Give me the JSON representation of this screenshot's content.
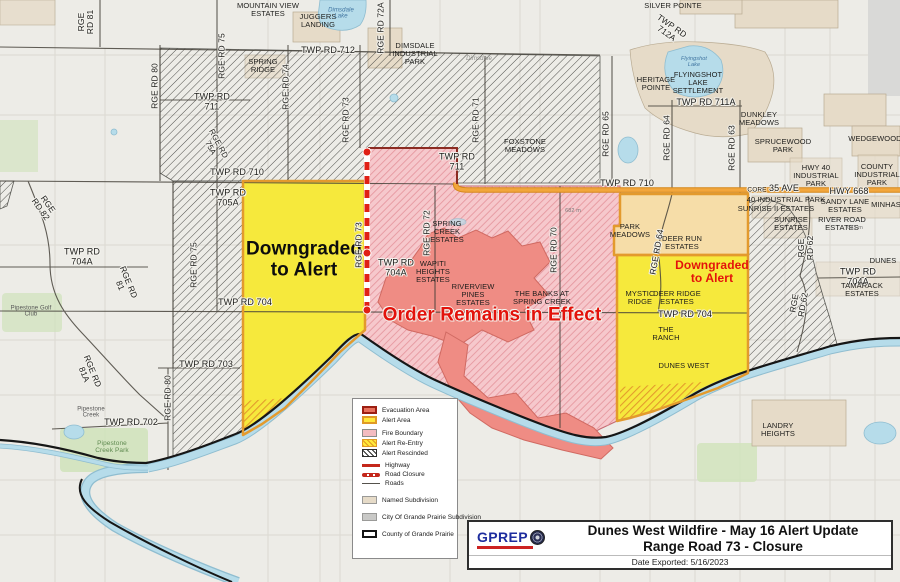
{
  "colors": {
    "bg": "#edece7",
    "alert_yellow": "#f6e93c",
    "alert_border": "#e39a2d",
    "evacuation_salmon": "#ef8c84",
    "fire_pink": "#f6c8cc",
    "fire_hatch": "#e698a0",
    "rescinded_line": "#3c3c38",
    "highway_orange": "#f2a63c",
    "highway_casing": "#d5881c",
    "closure_red": "#e02015",
    "river_blue": "#b6dcea",
    "river_casing": "#8fbdd0",
    "boundary_black": "#161616",
    "tan_subdivision": "#e6dbc8",
    "gray_subdivision": "#d9d9d7",
    "green_park": "#cfe3ba",
    "road_dark": "#454239"
  },
  "legend": {
    "items": [
      {
        "label": "Evacuation Area",
        "swatch": {
          "type": "rect",
          "fill": "#e8705c",
          "border": "#9c1f12",
          "bw": 2
        }
      },
      {
        "label": "Alert Area",
        "swatch": {
          "type": "rect",
          "fill": "#ffe93b",
          "border": "#e09a26",
          "bw": 2
        }
      },
      {
        "label": "Fire Boundary",
        "swatch": {
          "type": "rect",
          "fill": "#f4bcc1",
          "border": "#8d8d8b",
          "bw": 1
        }
      },
      {
        "label": "Alert Re-Entry",
        "swatch": {
          "type": "hatch",
          "fill": "#ffe93b",
          "line": "#e09a26",
          "border": "#e09a26",
          "bw": 1
        }
      },
      {
        "label": "Alert Rescinded",
        "swatch": {
          "type": "hatch",
          "fill": "#ffffff",
          "line": "#2e2e2c",
          "border": "#2e2e2c",
          "bw": 1
        }
      },
      {
        "label": "Highway",
        "swatch": {
          "type": "line",
          "color": "#c4271b"
        }
      },
      {
        "label": "Road Closure",
        "swatch": {
          "type": "dash",
          "color": "#c4271b"
        }
      },
      {
        "label": "Roads",
        "swatch": {
          "type": "thin",
          "color": "#55524c"
        }
      },
      {
        "label": "Named Subdivision",
        "swatch": {
          "type": "rect",
          "fill": "#e6dbc8",
          "border": "#9a9a98",
          "bw": 1
        }
      },
      {
        "label": "City Of Grande Prairie Subdivision",
        "swatch": {
          "type": "rect",
          "fill": "#c9c9c7",
          "border": "#9a9a98",
          "bw": 1
        }
      },
      {
        "label": "County of Grande Prairie",
        "swatch": {
          "type": "rect",
          "fill": "#ffffff",
          "border": "#141414",
          "bw": 2
        }
      }
    ]
  },
  "title_box": {
    "logo": "GPREP",
    "line1": "Dunes West Wildfire - May 16 Alert Update",
    "line2": "Range Road 73 - Closure",
    "date": "Date Exported: 5/16/2023"
  },
  "map": {
    "labels": [
      {
        "n": "mountain-view-estates-label",
        "t": "MOUNTAIN VIEW\nESTATES",
        "x": 268,
        "y": 10,
        "s": 7.5
      },
      {
        "n": "silver-pointe-label",
        "t": "SILVER POINTE",
        "x": 673,
        "y": 6,
        "s": 7.5
      },
      {
        "n": "juggers-landing-label",
        "t": "JUGGERS\nLANDING",
        "x": 318,
        "y": 21,
        "s": 7.5
      },
      {
        "n": "twp-rd-712a-label",
        "t": "TWP RD\n712A",
        "x": 669,
        "y": 30,
        "s": 8.5,
        "r": 35,
        "h": 1
      },
      {
        "n": "twp-rd-712-label",
        "t": "TWP RD 712",
        "x": 328,
        "y": 51,
        "s": 9,
        "h": 1
      },
      {
        "n": "dimsdale-industrial-park-label",
        "t": "DIMSDALE\nINDUSTRIAL\nPARK",
        "x": 415,
        "y": 54,
        "s": 7.5
      },
      {
        "n": "dimsdale-lake-label",
        "t": "Dimsdale\nLake",
        "x": 341,
        "y": 14,
        "s": 6,
        "i": 1,
        "c": "#3f74a0"
      },
      {
        "n": "rge-rd-81-label",
        "t": "RGE\nRD 81",
        "x": 86,
        "y": 22,
        "s": 8.5,
        "r": -90,
        "h": 1
      },
      {
        "n": "rge-rd-80-label",
        "t": "RGE RD 80",
        "x": 155,
        "y": 86,
        "s": 8.5,
        "r": -90,
        "h": 1
      },
      {
        "n": "rge-rd-75-label",
        "t": "RGE RD 75",
        "x": 222,
        "y": 56,
        "s": 8.5,
        "r": -90,
        "h": 1
      },
      {
        "n": "spring-ridge-label",
        "t": "SPRING\nRIDGE",
        "x": 263,
        "y": 66,
        "s": 7.5
      },
      {
        "n": "rge-rd-74-label",
        "t": "RGE RD 74",
        "x": 286,
        "y": 87,
        "s": 8.5,
        "r": -90,
        "h": 1
      },
      {
        "n": "twp-rd-711-label-west",
        "t": "TWP RD\n711",
        "x": 212,
        "y": 102,
        "s": 9,
        "h": 1
      },
      {
        "n": "rge-rd-75a-label",
        "t": "RGE RD\n75A",
        "x": 214,
        "y": 146,
        "s": 8,
        "r": 62,
        "h": 1
      },
      {
        "n": "twp-rd-710-label-west",
        "t": "TWP RD 710",
        "x": 237,
        "y": 173,
        "s": 9,
        "h": 1
      },
      {
        "n": "rge-rd-73-label-north",
        "t": "RGE RD 73",
        "x": 346,
        "y": 120,
        "s": 8.5,
        "r": -90,
        "h": 1
      },
      {
        "n": "rge-rd-72a-label",
        "t": "RGE RD 72A",
        "x": 381,
        "y": 28,
        "s": 8.5,
        "r": -90,
        "h": 1
      },
      {
        "n": "rge-rd-71-label",
        "t": "RGE RD 71",
        "x": 476,
        "y": 120,
        "s": 8.5,
        "r": -90,
        "h": 1
      },
      {
        "n": "twp-rd-711-label-mid",
        "t": "TWP RD\n711",
        "x": 457,
        "y": 162,
        "s": 9,
        "h": 1
      },
      {
        "n": "foxstone-meadows-label",
        "t": "FOXSTONE\nMEADOWS",
        "x": 525,
        "y": 146,
        "s": 7.5
      },
      {
        "n": "rge-rd-65-label",
        "t": "RGE RD 65",
        "x": 606,
        "y": 134,
        "s": 8.5,
        "r": -90,
        "h": 1
      },
      {
        "n": "twp-rd-711a-label",
        "t": "TWP RD 711A",
        "x": 706,
        "y": 103,
        "s": 9,
        "h": 1
      },
      {
        "n": "rge-rd-64-label-north",
        "t": "RGE RD 64",
        "x": 667,
        "y": 138,
        "s": 8.5,
        "r": -90,
        "h": 1
      },
      {
        "n": "rge-rd-63-label",
        "t": "RGE RD 63",
        "x": 732,
        "y": 148,
        "s": 8.5,
        "r": -90,
        "h": 1
      },
      {
        "n": "heritage-pointe-label",
        "t": "HERITAGE\nPOINTE",
        "x": 656,
        "y": 84,
        "s": 7.5
      },
      {
        "n": "flyingshot-lake-label",
        "t": "Flyingshot\nLake",
        "x": 694,
        "y": 63,
        "s": 5.5,
        "i": 1,
        "c": "#3f74a0"
      },
      {
        "n": "flyingshot-lake-settlement-label",
        "t": "FLYINGSHOT\nLAKE\nSETTLEMENT",
        "x": 698,
        "y": 83,
        "s": 7.5
      },
      {
        "n": "dunkley-meadows-label",
        "t": "DUNKLEY\nMEADOWS",
        "x": 759,
        "y": 119,
        "s": 7.5
      },
      {
        "n": "sprucewood-park-label",
        "t": "SPRUCEWOOD\nPARK",
        "x": 783,
        "y": 146,
        "s": 7.5
      },
      {
        "n": "wedgewood-label",
        "t": "WEDGEWOOD",
        "x": 875,
        "y": 139,
        "s": 7.5
      },
      {
        "n": "hwy-40-industrial-park-label",
        "t": "HWY 40\nINDUSTRIAL\nPARK",
        "x": 816,
        "y": 176,
        "s": 7.5
      },
      {
        "n": "county-industrial-park-label",
        "t": "COUNTY\nINDUSTRIAL\nPARK",
        "x": 877,
        "y": 175,
        "s": 7.5
      },
      {
        "n": "core-label",
        "t": "CORE",
        "x": 757,
        "y": 190,
        "s": 6.5,
        "h": 1
      },
      {
        "n": "ave-35-label",
        "t": "35 AVE",
        "x": 784,
        "y": 189,
        "s": 9,
        "h": 1
      },
      {
        "n": "hwy-668-label",
        "t": "HWY 668",
        "x": 849,
        "y": 192,
        "s": 9,
        "h": 1
      },
      {
        "n": "forty-industrial-park-label",
        "t": "40 INDUSTRIAL PARK",
        "x": 786,
        "y": 200,
        "s": 7.5
      },
      {
        "n": "sunrise-ii-estates-label",
        "t": "SUNRISE II ESTATES",
        "x": 776,
        "y": 209,
        "s": 7.5
      },
      {
        "n": "sandy-lane-estates-label",
        "t": "SANDY LANE\nESTATES",
        "x": 845,
        "y": 206,
        "s": 7.5
      },
      {
        "n": "minhas-label",
        "t": "MINHAS",
        "x": 886,
        "y": 205,
        "s": 7.5
      },
      {
        "n": "sunrise-estates-label",
        "t": "SUNRISE\nESTATES",
        "x": 791,
        "y": 224,
        "s": 7.5
      },
      {
        "n": "river-road-estates-label",
        "t": "RIVER ROAD\nESTATES",
        "x": 842,
        "y": 224,
        "s": 7.5
      },
      {
        "n": "rge-rd-62-label-upper",
        "t": "RGE\nRD 62",
        "x": 806,
        "y": 248,
        "s": 8.5,
        "r": -90,
        "h": 1
      },
      {
        "n": "rge-rd-62-label-lower",
        "t": "RGE\nRD 62",
        "x": 799,
        "y": 304,
        "s": 8.5,
        "r": -80,
        "h": 1
      },
      {
        "n": "twp-rd-704a-label-right",
        "t": "TWP RD 704A",
        "x": 858,
        "y": 277,
        "s": 9,
        "h": 1
      },
      {
        "n": "tamarack-estates-label",
        "t": "TAMARACK ESTATES",
        "x": 862,
        "y": 290,
        "s": 7.5
      },
      {
        "n": "dunes-label-edge",
        "t": "DUNES",
        "x": 883,
        "y": 261,
        "s": 7.5
      },
      {
        "n": "twp-rd-705a-label",
        "t": "TWP RD\n705A",
        "x": 228,
        "y": 198,
        "s": 9,
        "h": 1
      },
      {
        "n": "rge-rd-75-label-south",
        "t": "RGE RD 75",
        "x": 194,
        "y": 265,
        "s": 8.5,
        "r": -90,
        "h": 1
      },
      {
        "n": "downgraded-alert-west-label",
        "t": "Downgraded\nto Alert",
        "x": 304,
        "y": 260,
        "s": 19,
        "b": 1,
        "c": "#0d0d0d"
      },
      {
        "n": "rge-rd-73-label-mid",
        "t": "RGE RD 73",
        "x": 359,
        "y": 245,
        "s": 8.5,
        "r": -90,
        "h": 1
      },
      {
        "n": "twp-rd-704a-label-mid",
        "t": "TWP RD\n704A",
        "x": 396,
        "y": 268,
        "s": 9,
        "h": 1
      },
      {
        "n": "rge-rd-72-label",
        "t": "RGE RD 72",
        "x": 427,
        "y": 233,
        "s": 8.5,
        "r": -90,
        "h": 1
      },
      {
        "n": "spring-creek-estates-label",
        "t": "SPRING\nCREEK\nESTATES",
        "x": 447,
        "y": 232,
        "s": 7.5
      },
      {
        "n": "wapiti-heights-estates-label",
        "t": "WAPITI\nHEIGHTS\nESTATES",
        "x": 433,
        "y": 272,
        "s": 7.5
      },
      {
        "n": "riverview-pines-estates-label",
        "t": "RIVERVIEW\nPINES\nESTATES",
        "x": 473,
        "y": 295,
        "s": 7.5
      },
      {
        "n": "rge-rd-70-label",
        "t": "RGE RD 70",
        "x": 554,
        "y": 250,
        "s": 8.5,
        "r": -90,
        "h": 1
      },
      {
        "n": "banks-spring-creek-label",
        "t": "THE BANKS AT\nSPRING CREEK",
        "x": 542,
        "y": 298,
        "s": 7.5
      },
      {
        "n": "order-remains-label",
        "t": "Order Remains in Effect",
        "x": 492,
        "y": 316,
        "s": 19,
        "b": 1,
        "c": "#e3120b",
        "h": 1
      },
      {
        "n": "park-meadows-label",
        "t": "PARK\nMEADOWS",
        "x": 630,
        "y": 231,
        "s": 7.5
      },
      {
        "n": "rge-rd-64-label-mid",
        "t": "RGE RD 64",
        "x": 657,
        "y": 252,
        "s": 8.5,
        "r": -80,
        "h": 1
      },
      {
        "n": "deer-run-estates-label",
        "t": "DEER RUN\nESTATES",
        "x": 682,
        "y": 243,
        "s": 7.5
      },
      {
        "n": "downgraded-alert-east-label",
        "t": "Downgraded\nto Alert",
        "x": 712,
        "y": 272,
        "s": 12,
        "b": 1,
        "c": "#e3120b"
      },
      {
        "n": "mystic-ridge-label",
        "t": "MYSTIC\nRIDGE",
        "x": 640,
        "y": 298,
        "s": 7.5
      },
      {
        "n": "deer-ridge-estates-label",
        "t": "DEER RIDGE\nESTATES",
        "x": 677,
        "y": 298,
        "s": 7.5
      },
      {
        "n": "twp-rd-704-label-east",
        "t": "TWP RD 704",
        "x": 685,
        "y": 315,
        "s": 9,
        "h": 1
      },
      {
        "n": "the-ranch-label",
        "t": "THE\nRANCH",
        "x": 666,
        "y": 334,
        "s": 7.5
      },
      {
        "n": "dunes-west-label",
        "t": "DUNES WEST",
        "x": 684,
        "y": 366,
        "s": 7.5
      },
      {
        "n": "landry-heights-label",
        "t": "LANDRY\nHEIGHTS",
        "x": 778,
        "y": 430,
        "s": 7.5
      },
      {
        "n": "twp-rd-704-label-west",
        "t": "TWP RD 704",
        "x": 245,
        "y": 303,
        "s": 9,
        "h": 1
      },
      {
        "n": "twp-rd-703-label",
        "t": "TWP RD 703",
        "x": 206,
        "y": 365,
        "s": 9,
        "h": 1
      },
      {
        "n": "rge-rd-80-label-south",
        "t": "RGE RD 80",
        "x": 168,
        "y": 398,
        "s": 8.5,
        "r": -90,
        "h": 1
      },
      {
        "n": "rge-rd-81a-label",
        "t": "RGE RD\n81A",
        "x": 88,
        "y": 373,
        "s": 8.5,
        "r": 68,
        "h": 1
      },
      {
        "n": "twp-rd-702-label",
        "t": "TWP RD 702",
        "x": 131,
        "y": 423,
        "s": 9,
        "h": 1
      },
      {
        "n": "pipestone-creek-label",
        "t": "Pipestone\nCreek",
        "x": 91,
        "y": 413,
        "s": 6,
        "c": "#555"
      },
      {
        "n": "pipestone-golf-club-label",
        "t": "Pipestone Golf\nClub",
        "x": 31,
        "y": 312,
        "s": 6,
        "c": "#555"
      },
      {
        "n": "pipestone-creek-park-label",
        "t": "Pipestone\nCreek Park",
        "x": 112,
        "y": 447,
        "s": 6.5,
        "c": "#5f8a50"
      },
      {
        "n": "twp-rd-704a-label-west",
        "t": "TWP RD\n704A",
        "x": 82,
        "y": 257,
        "s": 9,
        "h": 1
      },
      {
        "n": "rge-rd-82-label",
        "t": "RGE\nRD 82",
        "x": 44,
        "y": 207,
        "s": 8.5,
        "r": 55,
        "h": 1
      },
      {
        "n": "rge-rd-81-label-diag",
        "t": "RGE RD\n81",
        "x": 124,
        "y": 284,
        "s": 8.5,
        "r": 68,
        "h": 1
      },
      {
        "n": "twp-rd-710-label-east",
        "t": "TWP RD 710",
        "x": 627,
        "y": 184,
        "s": 9,
        "h": 1
      },
      {
        "n": "elev-682-label",
        "t": "682 m",
        "x": 573,
        "y": 212,
        "s": 5.5,
        "c": "#777"
      },
      {
        "n": "elev-683-label",
        "t": "683 m",
        "x": 855,
        "y": 229,
        "s": 5.5,
        "c": "#777"
      },
      {
        "n": "dimsdale-road-label",
        "t": "Dimsdale",
        "x": 479,
        "y": 59,
        "s": 6,
        "i": 1,
        "c": "#8a8a86"
      }
    ]
  }
}
